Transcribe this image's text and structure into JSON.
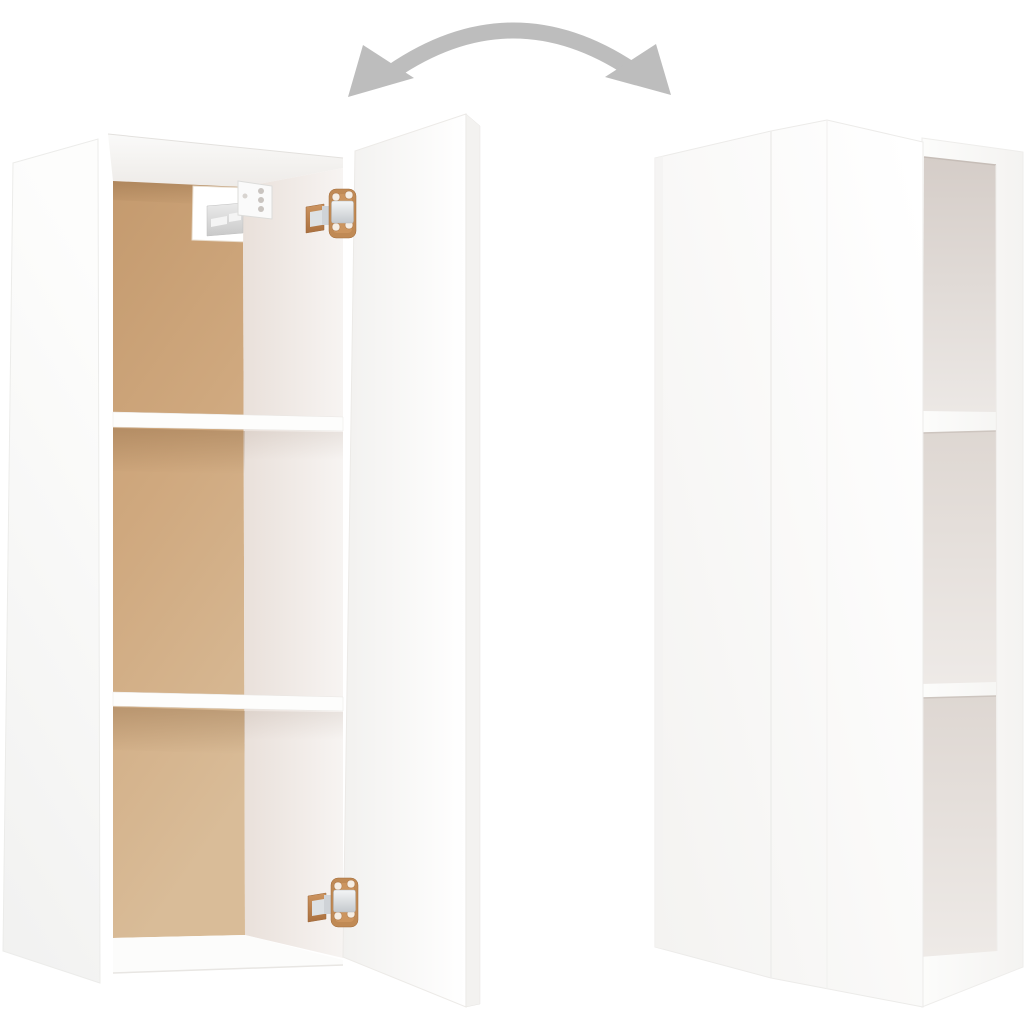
{
  "image": {
    "alt": "Product photo of a white wall-mounted cabinet shown from two angles: on the left it is open, revealing three compartments, two white shelves, a wood-toned back panel, a chrome wall-mount bracket and two copper-and-chrome hinges on the open door; on the right the same cabinet is rotated, showing its plain white closed face and three open side compartments. A gray curved double-headed arrow above indicates the rotation.",
    "background": "#ffffff"
  },
  "rotation_arrow": {
    "name": "rotation-arrow",
    "color": "#bdbdbd"
  },
  "open_view": {
    "label": "Cabinet shown open with door swung out",
    "compartments": 3,
    "shelves": 2,
    "back_panel": {
      "top": "#c49a6e",
      "middle": "#cfa87e",
      "bottom": "#d9bc98"
    },
    "door_color": "#fbfbfa",
    "side_panel_color": "#f8f8f7",
    "interior_wall": {
      "dark": "#e9e0da",
      "light": "#f7f4f2"
    }
  },
  "closed_view": {
    "label": "Cabinet rotated showing closed face and open side compartments",
    "side_openings": 3,
    "face_color": "#fbfbfa",
    "opening_colors": {
      "dark": "#d5cdc8",
      "light": "#ece8e5"
    }
  },
  "hardware": {
    "hinge_count": 2,
    "hinge_plate_color": "#c08a55",
    "hinge_chrome_color": "#dde1e4",
    "mount_rail_color": "#d6d6d6",
    "mount_block_color": "#fafafa"
  }
}
